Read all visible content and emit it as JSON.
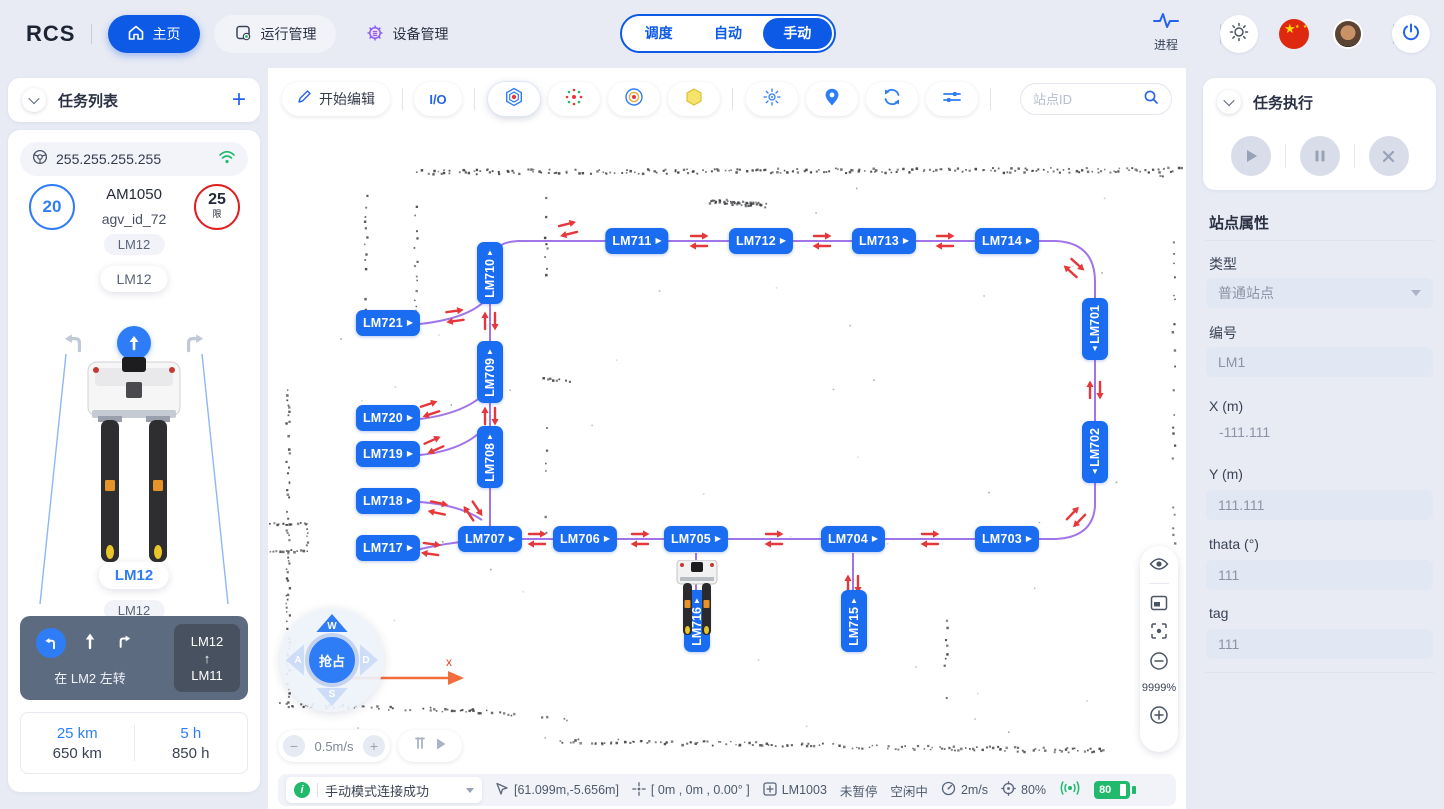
{
  "header": {
    "logo": "RCS",
    "nav": [
      {
        "label": "主页",
        "icon": "home-icon"
      },
      {
        "label": "运行管理",
        "icon": "monitor-gear-icon"
      },
      {
        "label": "设备管理",
        "icon": "gear-icon"
      }
    ],
    "mode_tabs": [
      {
        "label": "调度"
      },
      {
        "label": "自动"
      },
      {
        "label": "手动",
        "active": true
      }
    ],
    "process_label": "进程"
  },
  "left_panel": {
    "title": "任务列表",
    "ip": "255.255.255.255",
    "speed": "20",
    "model": "AM1050",
    "agv_id": "agv_id_72",
    "limit": "25",
    "limit_unit": "限",
    "station_chip1": "LM12",
    "station_chip2": "LM12",
    "front_station": "LM12",
    "back_station": "LM12",
    "nav_text": "在 LM2 左转",
    "route_from": "LM12",
    "route_arrow": "↑",
    "route_to": "LM11",
    "stat_km_current": "25 km",
    "stat_km_total": "650 km",
    "stat_h_current": "5 h",
    "stat_h_total": "850 h"
  },
  "map": {
    "toolbar": {
      "edit": "开始编辑",
      "io": "I/O",
      "search_placeholder": "站点ID",
      "icons": [
        "station-normal-icon",
        "scatter-points-icon",
        "target-rings-icon",
        "area-hexagon-icon",
        "radar-icon",
        "location-pin-icon",
        "refresh-icon",
        "filter-sliders-icon"
      ]
    },
    "stations": [
      {
        "label": "LM711",
        "x": 369,
        "y": 173,
        "dir": "h"
      },
      {
        "label": "LM712",
        "x": 493,
        "y": 173,
        "dir": "h"
      },
      {
        "label": "LM713",
        "x": 616,
        "y": 173,
        "dir": "h"
      },
      {
        "label": "LM714",
        "x": 739,
        "y": 173,
        "dir": "h"
      },
      {
        "label": "LM710",
        "x": 222,
        "y": 205,
        "dir": "vu"
      },
      {
        "label": "LM709",
        "x": 222,
        "y": 304,
        "dir": "vu"
      },
      {
        "label": "LM708",
        "x": 222,
        "y": 389,
        "dir": "vu"
      },
      {
        "label": "LM721",
        "x": 120,
        "y": 255,
        "dir": "h"
      },
      {
        "label": "LM720",
        "x": 120,
        "y": 350,
        "dir": "h"
      },
      {
        "label": "LM719",
        "x": 120,
        "y": 386,
        "dir": "h"
      },
      {
        "label": "LM718",
        "x": 120,
        "y": 433,
        "dir": "h"
      },
      {
        "label": "LM717",
        "x": 120,
        "y": 480,
        "dir": "h"
      },
      {
        "label": "LM707",
        "x": 222,
        "y": 471,
        "dir": "h"
      },
      {
        "label": "LM706",
        "x": 317,
        "y": 471,
        "dir": "h"
      },
      {
        "label": "LM705",
        "x": 428,
        "y": 471,
        "dir": "h"
      },
      {
        "label": "LM704",
        "x": 585,
        "y": 471,
        "dir": "h"
      },
      {
        "label": "LM703",
        "x": 739,
        "y": 471,
        "dir": "h"
      },
      {
        "label": "LM701",
        "x": 827,
        "y": 261,
        "dir": "vd"
      },
      {
        "label": "LM702",
        "x": 827,
        "y": 384,
        "dir": "vd"
      },
      {
        "label": "LM715",
        "x": 586,
        "y": 553,
        "dir": "vu"
      },
      {
        "label": "LM716",
        "x": 429,
        "y": 553,
        "dir": "vu"
      }
    ],
    "joystick": {
      "up": "W",
      "left": "A",
      "down": "S",
      "right": "D",
      "center": "抢占"
    },
    "axis_label": "x",
    "speed_value": "0.5m/s",
    "zoom_value": "9999%"
  },
  "right_panel": {
    "exec_title": "任务执行",
    "props_title": "站点属性",
    "fields": [
      {
        "label": "类型",
        "value": "普通站点"
      },
      {
        "label": "编号",
        "value": "LM1"
      },
      {
        "label": "X (m)",
        "value": "-111.111"
      },
      {
        "label": "Y (m)",
        "value": "111.111"
      },
      {
        "label": "thata (°)",
        "value": "111"
      },
      {
        "label": "tag",
        "value": "111"
      }
    ]
  },
  "status_bar": {
    "message": "手动模式连接成功",
    "cursor_pos": "[61.099m,-5.656m]",
    "robot_pose": "[ 0m , 0m , 0.00° ]",
    "station_id": "LM1003",
    "pause_state": "未暂停",
    "work_state": "空闲中",
    "speed": "2m/s",
    "loc_quality": "80%",
    "battery": "80"
  },
  "colors": {
    "primary": "#0d5ae6",
    "station_blue": "#1a6cf0",
    "path_purple": "#a175e8",
    "arrow_red": "#e5383b",
    "green": "#21ba6c",
    "danger_red": "#e02020"
  }
}
